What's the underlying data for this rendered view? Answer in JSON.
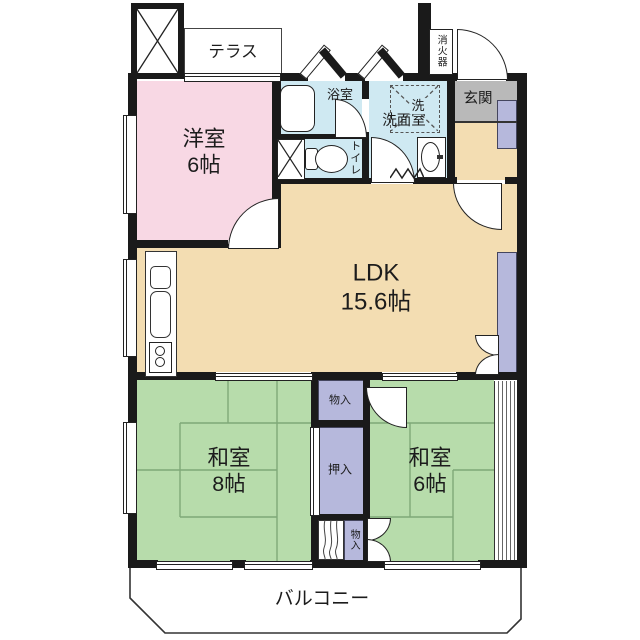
{
  "plan_title": "floor-plan",
  "rooms": {
    "terrace": {
      "label": "テラス"
    },
    "western": {
      "label": "洋室",
      "size": "6帖"
    },
    "bath": {
      "label": "浴室"
    },
    "washroom": {
      "label": "洗面室"
    },
    "laundry": {
      "label": "洗"
    },
    "toilet": {
      "label": "トイレ"
    },
    "entrance": {
      "label": "玄関"
    },
    "extinguisher": {
      "label": "消火器"
    },
    "ldk": {
      "label": "LDK",
      "size": "15.6帖"
    },
    "tatami8": {
      "label": "和室",
      "size": "8帖"
    },
    "tatami6": {
      "label": "和室",
      "size": "6帖"
    },
    "storage_upper": {
      "label": "物入"
    },
    "oshiire": {
      "label": "押入"
    },
    "storage_lower": {
      "label": "物入"
    },
    "balcony": {
      "label": "バルコニー"
    }
  },
  "colors": {
    "wall": "#1a1a1a",
    "western_room": "#f8d8e4",
    "water_rooms": "#cfe9f2",
    "ldk": "#f3ddb2",
    "tatami_rooms": "#b7dcab",
    "storage": "#b6b8dc",
    "entrance_floor": "#b9b9b9",
    "tatami_line": "#7fa878"
  }
}
